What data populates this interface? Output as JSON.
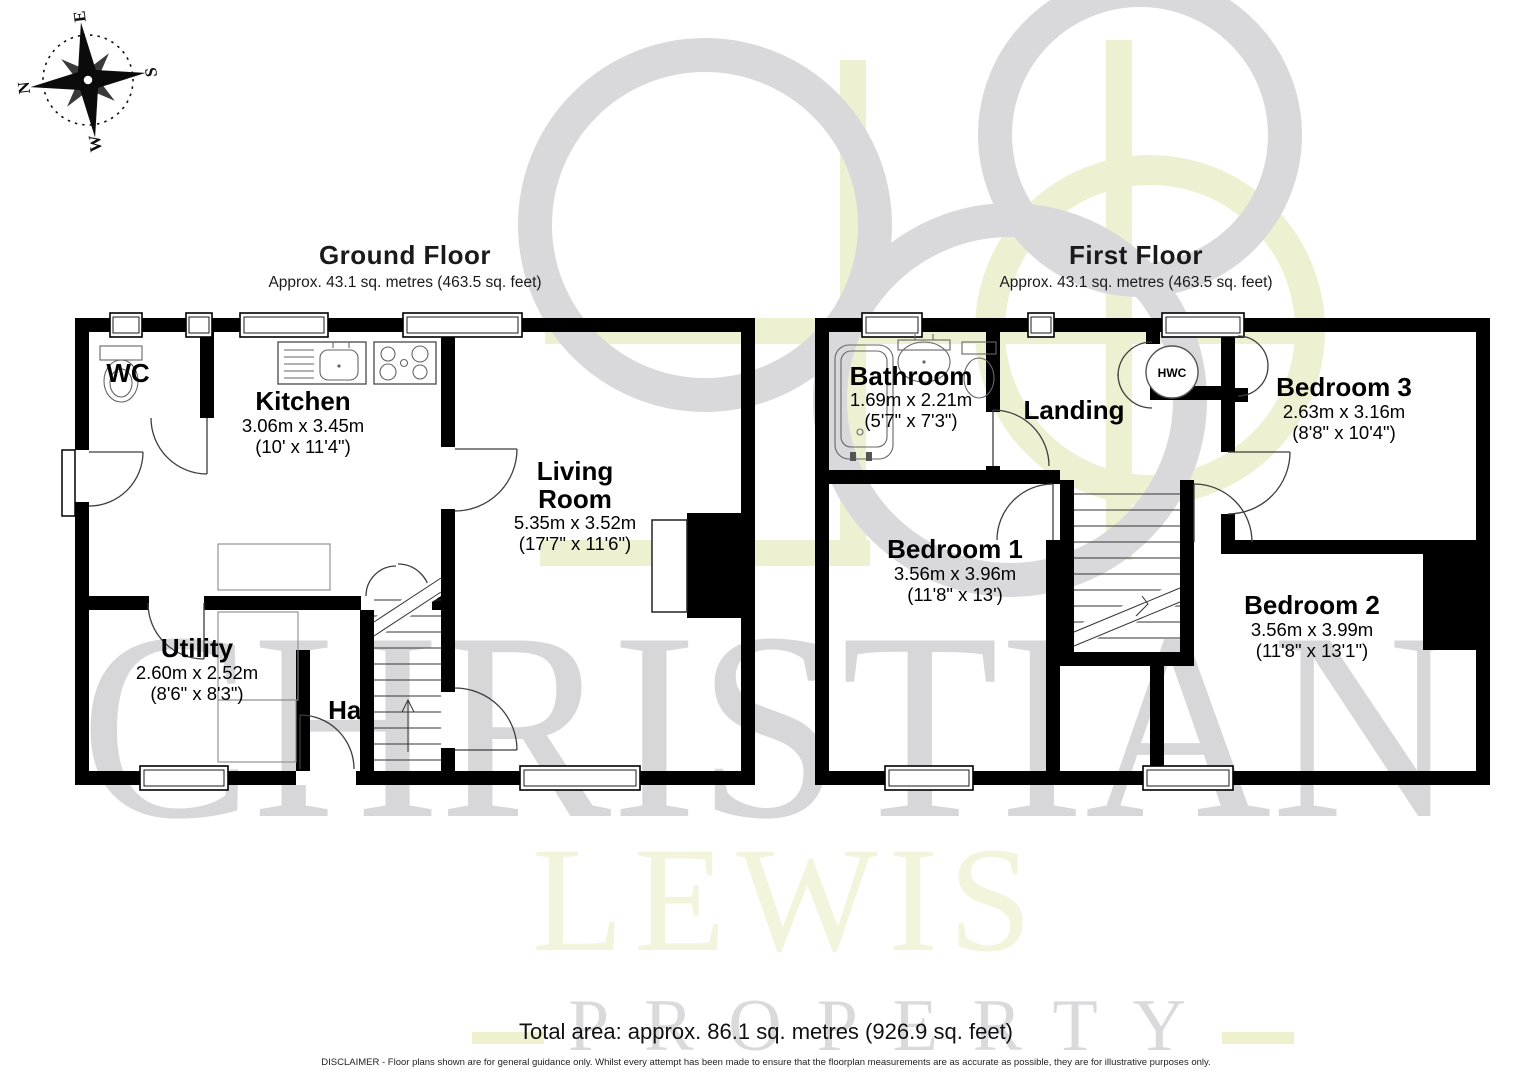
{
  "compass": {
    "n": "N",
    "e": "E",
    "s": "S",
    "w": "W"
  },
  "watermark": {
    "line1": "CHRISTIAN",
    "line2": "LEWIS",
    "line3": "PROPERTY"
  },
  "ground_floor": {
    "title": "Ground Floor",
    "subtitle": "Approx. 43.1 sq. metres (463.5 sq. feet)",
    "rooms": {
      "wc": {
        "name": "WC"
      },
      "kitchen": {
        "name": "Kitchen",
        "metric": "3.06m x 3.45m",
        "imperial": "(10' x 11'4\")"
      },
      "living": {
        "name_line1": "Living",
        "name_line2": "Room",
        "metric": "5.35m x 3.52m",
        "imperial": "(17'7\" x 11'6\")"
      },
      "utility": {
        "name": "Utility",
        "metric": "2.60m x 2.52m",
        "imperial": "(8'6\" x 8'3\")"
      },
      "hall": {
        "name": "Hall"
      }
    }
  },
  "first_floor": {
    "title": "First Floor",
    "subtitle": "Approx. 43.1 sq. metres (463.5 sq. feet)",
    "rooms": {
      "bathroom": {
        "name": "Bathroom",
        "metric": "1.69m x 2.21m",
        "imperial": "(5'7\" x 7'3\")"
      },
      "landing": {
        "name": "Landing"
      },
      "hwc": {
        "name": "HWC"
      },
      "bedroom1": {
        "name": "Bedroom 1",
        "metric": "3.56m x 3.96m",
        "imperial": "(11'8\" x 13')"
      },
      "bedroom2": {
        "name": "Bedroom 2",
        "metric": "3.56m x 3.99m",
        "imperial": "(11'8\" x 13'1\")"
      },
      "bedroom3": {
        "name": "Bedroom 3",
        "metric": "2.63m x 3.16m",
        "imperial": "(8'8\" x 10'4\")"
      }
    }
  },
  "footer": {
    "total_area": "Total area: approx. 86.1 sq. metres (926.9 sq. feet)",
    "disclaimer": "DISCLAIMER -  Floor plans shown are for general guidance only. Whilst every attempt has been made to ensure that the floorplan measurements are as accurate as possible, they are for illustrative purposes only."
  },
  "colors": {
    "wall": "#000000",
    "watermark_gray": "#d9d9db",
    "watermark_yellow": "#eef0d2",
    "watermark_lewis": "#f2f4dc"
  }
}
